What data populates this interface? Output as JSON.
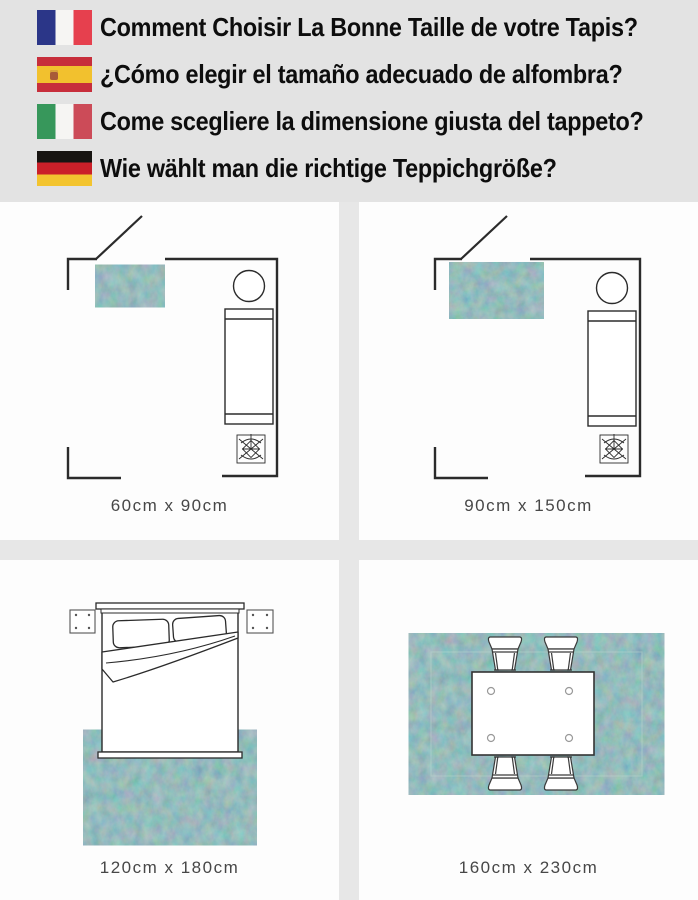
{
  "header": {
    "items": [
      {
        "language": "french",
        "flag": "france-flag",
        "text": "Comment Choisir La Bonne Taille de votre Tapis?"
      },
      {
        "language": "spanish",
        "flag": "spain-flag",
        "text": "¿Cómo elegir el tamaño adecuado de alfombra?"
      },
      {
        "language": "italian",
        "flag": "italy-flag",
        "text": "Come scegliere la dimensione giusta del tappeto?"
      },
      {
        "language": "german",
        "flag": "germany-flag",
        "text": "Wie wählt man die richtige Teppichgröße?"
      }
    ]
  },
  "panels": [
    {
      "scene": "living-room-floor-plan-small-rug",
      "label": "60cm x 90cm"
    },
    {
      "scene": "living-room-floor-plan-medium-rug",
      "label": "90cm x 150cm"
    },
    {
      "scene": "bedroom-top-view-rug-under-bed",
      "label": "120cm x 180cm"
    },
    {
      "scene": "dining-table-top-view-on-rug",
      "label": "160cm x 230cm"
    }
  ],
  "colors": {
    "header_bg": "#e3e3e3",
    "panel_bg": "#fdfdfd",
    "line": "#2b2b2b",
    "rug_teal": "#4e8184",
    "label_text": "#474747"
  }
}
